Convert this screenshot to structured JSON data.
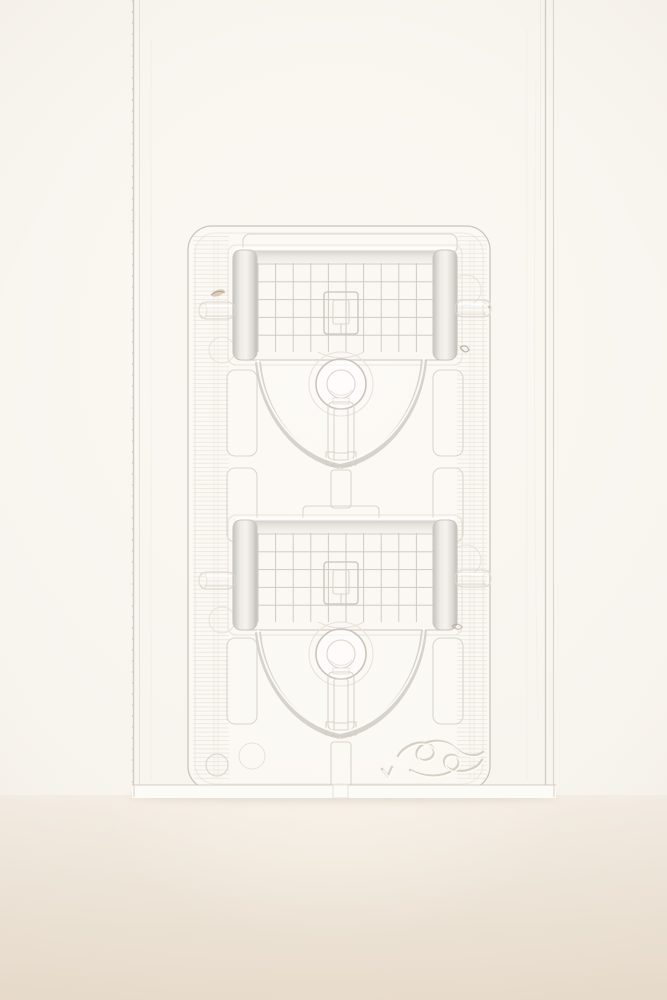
{
  "meta": {
    "type": "product-photograph",
    "orientation": "portrait",
    "subject": "upright clear clamshell blister package holding two transparent sewing-machine presser feet, on a warm beige tabletop against an off-white studio backdrop"
  },
  "colors": {
    "bg": "#f8f4ee",
    "bg_glow": "#fbf8f3",
    "surface_top": "#f2ebe1",
    "surface_mid": "#eee5d8",
    "surface_bottom": "#e9ddcd",
    "shadow": "rgba(176,158,138,0.30)",
    "line": "#c9c4bc",
    "line_soft": "#dad5cd",
    "line_faint": "#e7e2da",
    "fill_tray": "rgba(253,251,247,0.55)",
    "fill_item": "rgba(250,247,242,0.85)",
    "bright": "#ffffff",
    "grid": "#bcb8b1",
    "roll_dark": "#c2bfba",
    "roll_mid": "#f4f1ec",
    "cap_dark": "#cfccc7",
    "emboss_dark": "#d6cfc4",
    "emboss_light": "#fffdf8",
    "speck_brown": "#bfa584",
    "speck_gray": "#a69d90"
  },
  "scene": {
    "background_label": "seamless off-white studio backdrop",
    "surface_label": "warm beige tabletop",
    "package": {
      "label": "clear clamshell blister package, standing upright",
      "tray_label": "vacuum-formed blister tray with ribbed side margins",
      "emboss_label": "embossed script flourish logo",
      "mold_marks_label": "circular mold marks",
      "items": [
        {
          "label": "transparent presser foot with measurement grid (top cavity)"
        },
        {
          "label": "transparent presser foot with measurement grid (bottom cavity)"
        }
      ]
    }
  }
}
